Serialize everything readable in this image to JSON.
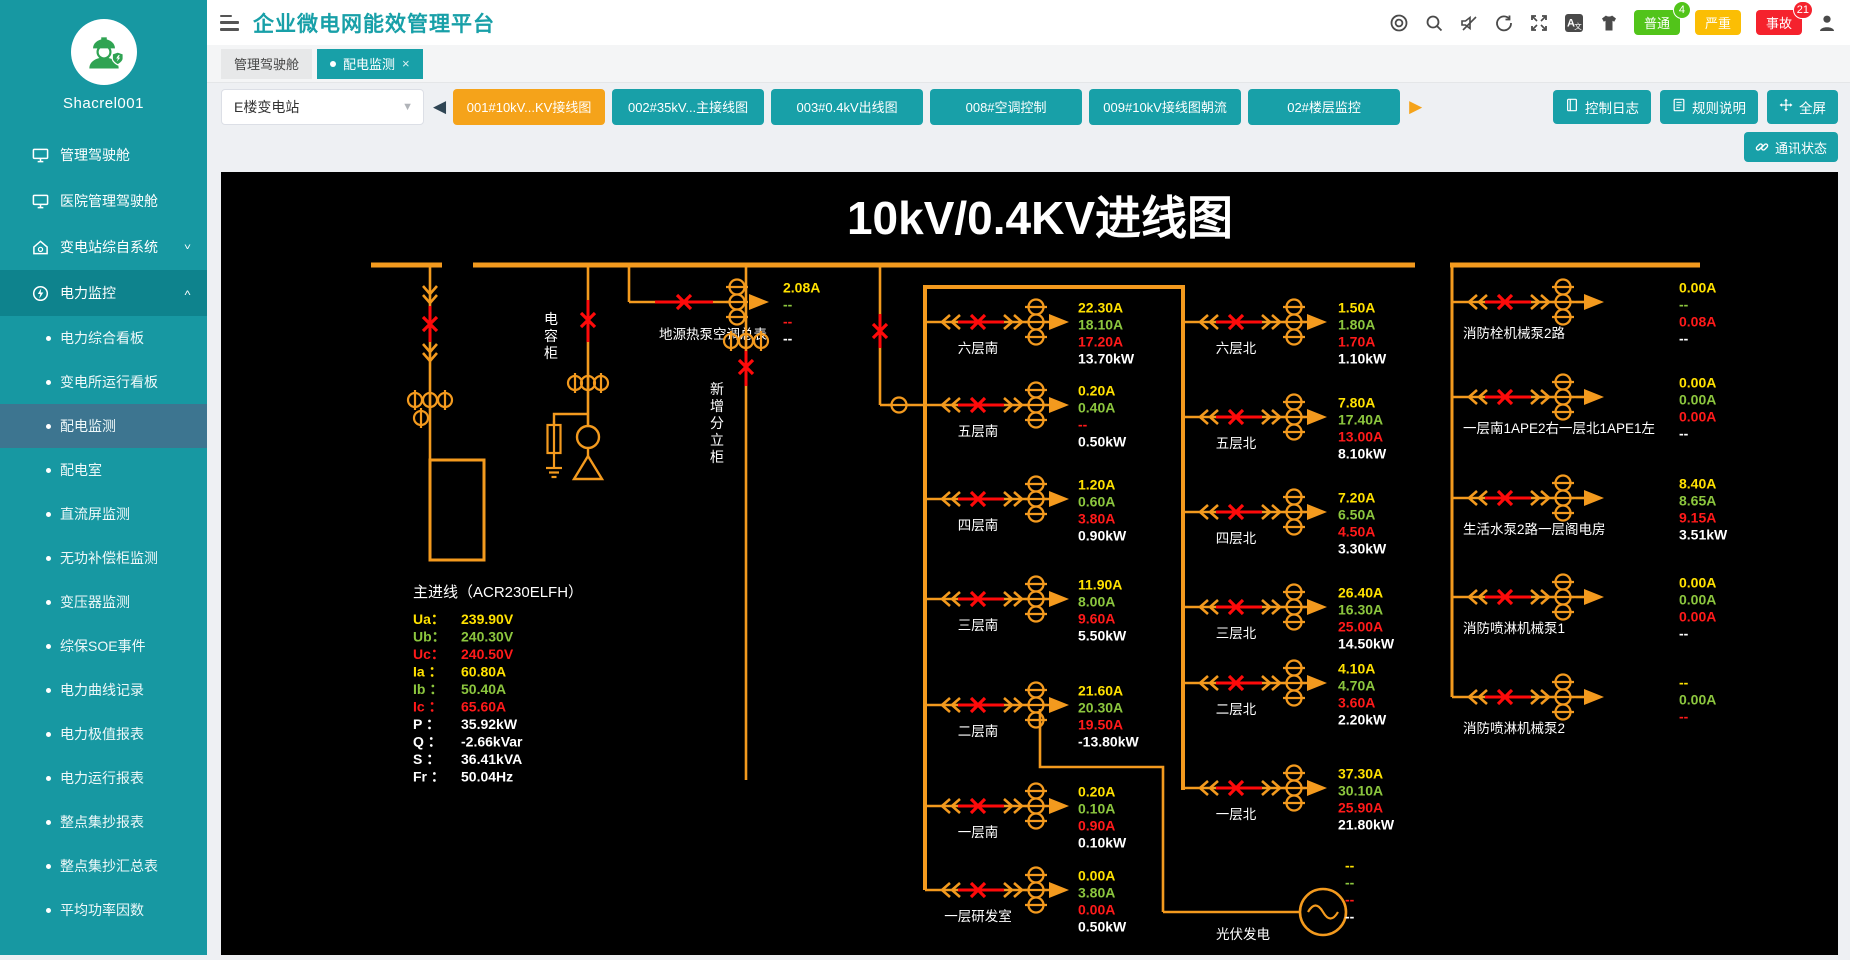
{
  "sidebar": {
    "username": "Shacrel001",
    "menu": [
      {
        "label": "管理驾驶舱",
        "icon": "monitor"
      },
      {
        "label": "医院管理驾驶舱",
        "icon": "monitor"
      },
      {
        "label": "变电站综自系统",
        "icon": "home",
        "chevron": "down"
      },
      {
        "label": "电力监控",
        "icon": "power",
        "chevron": "up",
        "expanded": true,
        "children": [
          "电力综合看板",
          "变电所运行看板",
          "配电监测",
          "配电室",
          "直流屏监测",
          "无功补偿柜监测",
          "变压器监测",
          "综保SOE事件",
          "电力曲线记录",
          "电力极值报表",
          "电力运行报表",
          "整点集抄报表",
          "整点集抄汇总表",
          "平均功率因数"
        ],
        "selected_child": "配电监测"
      }
    ]
  },
  "header": {
    "title": "企业微电网能效管理平台",
    "icon_names": [
      "target-icon",
      "search-icon",
      "mute-icon",
      "refresh-icon",
      "fullscreen-icon",
      "translate-icon",
      "theme-icon"
    ],
    "alarm_badges": [
      {
        "label": "普通",
        "count": "4",
        "color": "#52c41a"
      },
      {
        "label": "严重",
        "count": null,
        "color": "#FBBE04"
      },
      {
        "label": "事故",
        "count": "21",
        "color": "#f5222d"
      }
    ]
  },
  "tabs": [
    {
      "label": "管理驾驶舱",
      "active": false
    },
    {
      "label": "配电监测",
      "active": true,
      "closable": true
    }
  ],
  "toolbar": {
    "station_select": "E楼变电站",
    "station_tabs": [
      {
        "label": "001#10kV...KV接线图",
        "active": true
      },
      {
        "label": "002#35kV...主接线图",
        "active": false
      },
      {
        "label": "003#0.4kV出线图",
        "active": false
      },
      {
        "label": "008#空调控制",
        "active": false
      },
      {
        "label": "009#10kV接线图朝流",
        "active": false
      },
      {
        "label": "02#楼层监控",
        "active": false
      }
    ],
    "buttons": [
      "控制日志",
      "规则说明",
      "全屏"
    ],
    "comm_label": "通讯状态"
  },
  "diagram": {
    "title": "10kV/0.4KV进线图",
    "colors": {
      "orange": "#F39A1E",
      "red": "#FF0A0A",
      "value_sequence": [
        "#FFE100",
        "#8CC63E",
        "#FF1A1A",
        "#FFFFFF"
      ]
    },
    "capacitor_label": "电容柜",
    "new_cabinet_label": "新增分立柜",
    "heat_pump": {
      "label": "地源热泵空调总表",
      "values": [
        "2.08A",
        "--",
        "--",
        "--"
      ]
    },
    "main_feeder": {
      "label": "主进线（ACR230ELFH）",
      "rows": [
        {
          "k": "Ua：",
          "v": "239.90V",
          "c": 0
        },
        {
          "k": "Ub：",
          "v": "240.30V",
          "c": 1
        },
        {
          "k": "Uc：",
          "v": "240.50V",
          "c": 2
        },
        {
          "k": "Ia ：",
          "v": "60.80A",
          "c": 0
        },
        {
          "k": "Ib ：",
          "v": "50.40A",
          "c": 1
        },
        {
          "k": "Ic ：",
          "v": "65.60A",
          "c": 2
        },
        {
          "k": "P  ：",
          "v": "35.92kW",
          "c": 3
        },
        {
          "k": "Q  ：",
          "v": "-2.66kVar",
          "c": 3
        },
        {
          "k": "S  ：",
          "v": "36.41kVA",
          "c": 3
        },
        {
          "k": "Fr ：",
          "v": "50.04Hz",
          "c": 3
        }
      ]
    },
    "south": [
      {
        "label": "六层南",
        "values": [
          "22.30A",
          "18.10A",
          "17.20A",
          "13.70kW"
        ]
      },
      {
        "label": "五层南",
        "values": [
          "0.20A",
          "0.40A",
          "--",
          "0.50kW"
        ]
      },
      {
        "label": "四层南",
        "values": [
          "1.20A",
          "0.60A",
          "3.80A",
          "0.90kW"
        ]
      },
      {
        "label": "三层南",
        "values": [
          "11.90A",
          "8.00A",
          "9.60A",
          "5.50kW"
        ]
      },
      {
        "label": "二层南",
        "values": [
          "21.60A",
          "20.30A",
          "19.50A",
          "-13.80kW"
        ]
      },
      {
        "label": "一层南",
        "values": [
          "0.20A",
          "0.10A",
          "0.90A",
          "0.10kW"
        ]
      },
      {
        "label": "一层研发室",
        "values": [
          "0.00A",
          "3.80A",
          "0.00A",
          "0.50kW"
        ]
      }
    ],
    "north": [
      {
        "label": "六层北",
        "values": [
          "1.50A",
          "1.80A",
          "1.70A",
          "1.10kW"
        ]
      },
      {
        "label": "五层北",
        "values": [
          "7.80A",
          "17.40A",
          "13.00A",
          "8.10kW"
        ]
      },
      {
        "label": "四层北",
        "values": [
          "7.20A",
          "6.50A",
          "4.50A",
          "3.30kW"
        ]
      },
      {
        "label": "三层北",
        "values": [
          "26.40A",
          "16.30A",
          "25.00A",
          "14.50kW"
        ]
      },
      {
        "label": "二层北",
        "values": [
          "4.10A",
          "4.70A",
          "3.60A",
          "2.20kW"
        ]
      },
      {
        "label": "一层北",
        "values": [
          "37.30A",
          "30.10A",
          "25.90A",
          "21.80kW"
        ]
      }
    ],
    "right": [
      {
        "label": "消防栓机械泵2路",
        "values": [
          "0.00A",
          "--",
          "0.08A",
          "--"
        ]
      },
      {
        "label": "一层南1APE2右一层北1APE1左",
        "values": [
          "0.00A",
          "0.00A",
          "0.00A",
          "--"
        ]
      },
      {
        "label": "生活水泵2路一层阁电房",
        "values": [
          "8.40A",
          "8.65A",
          "9.15A",
          "3.51kW"
        ]
      },
      {
        "label": "消防喷淋机械泵1",
        "values": [
          "0.00A",
          "0.00A",
          "0.00A",
          "--"
        ]
      },
      {
        "label": "消防喷淋机械泵2",
        "values": [
          "--",
          "0.00A",
          "--",
          ""
        ]
      }
    ],
    "pv": {
      "label": "光伏发电",
      "values": [
        "--",
        "--",
        "--",
        "--"
      ]
    }
  }
}
